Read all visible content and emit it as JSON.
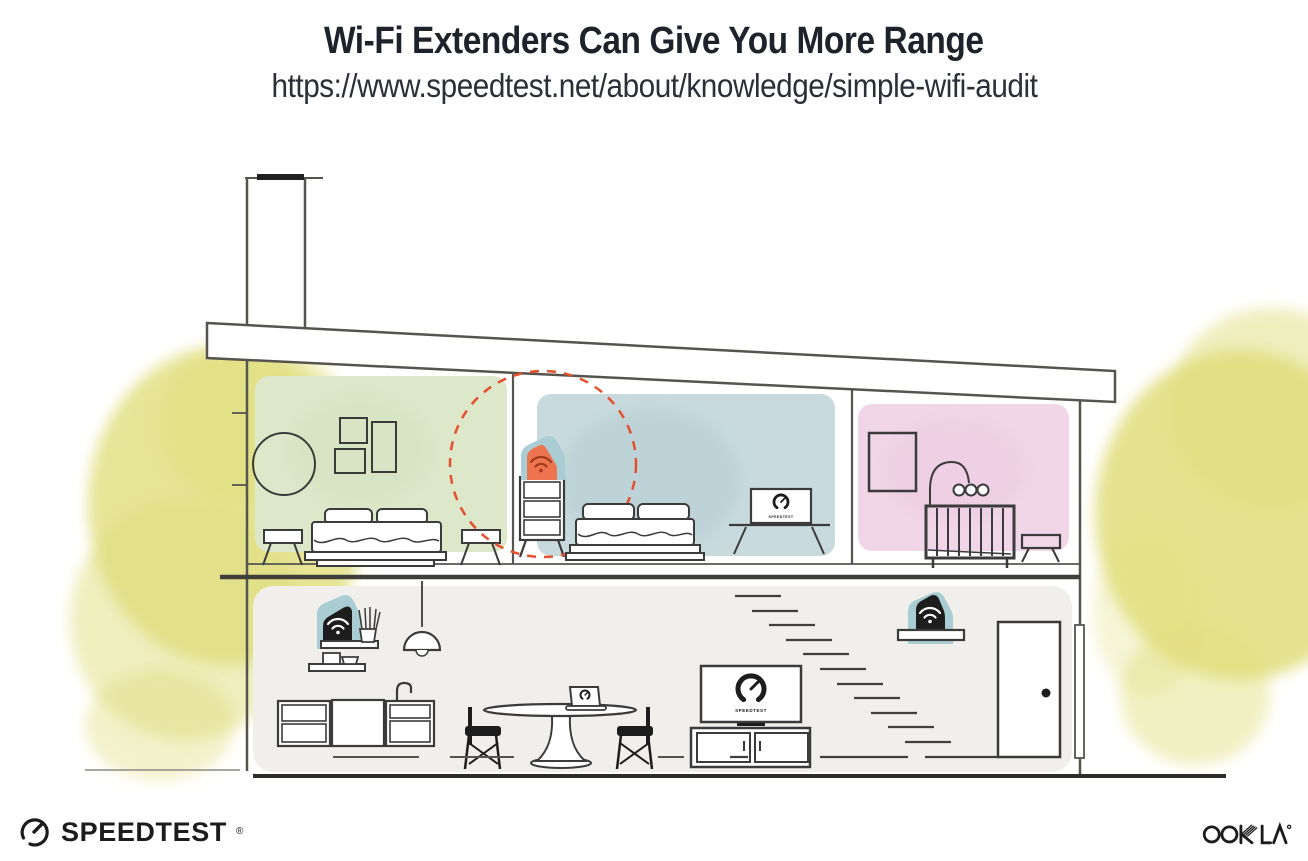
{
  "header": {
    "title": "Wi-Fi Extenders Can Give You More Range",
    "url": "https://www.speedtest.net/about/knowledge/simple-wifi-audit"
  },
  "illustration": {
    "screens": {
      "bedroom_tv": "SPEEDTEST",
      "living_room_tv": "SPEEDTEST"
    },
    "colors": {
      "green_room": "#dde7ca",
      "blue_room": "#c8dadd",
      "pink_room": "#f1d6e7",
      "lower_floor": "#f0efeb",
      "tree_yellow": "#e0dd7b",
      "extender_teal": "#a9cdd3",
      "extender_orange": "#ee7450",
      "wifi_dark_red": "#a03a1c",
      "range_circle_red": "#e4502e",
      "structure_gray": "#56544f",
      "furniture_line": "#3b3b3b",
      "ink": "#1d1d1d"
    }
  },
  "footer": {
    "speedtest_text": "SPEEDTEST",
    "speedtest_reg": "®",
    "ookla_text": "OOKLA"
  }
}
